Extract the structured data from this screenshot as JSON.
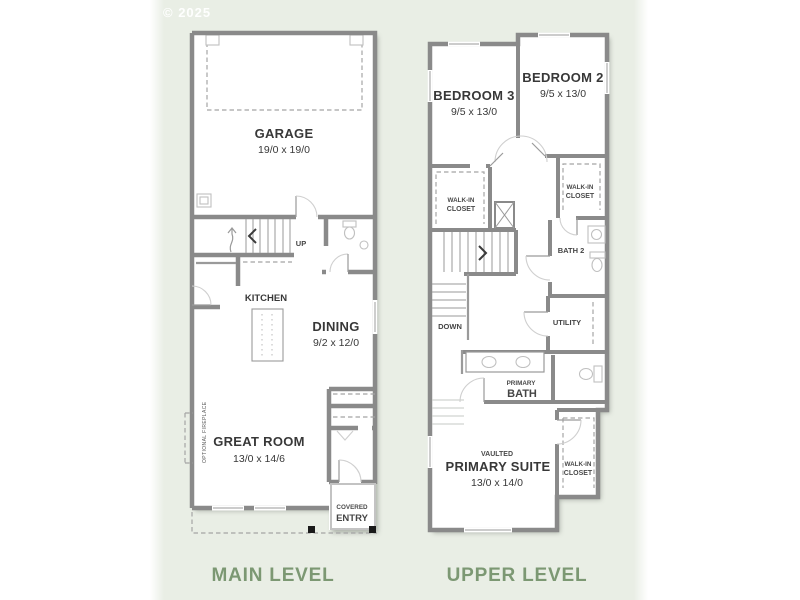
{
  "watermark": "© 2025",
  "colors": {
    "panel_background": "#e9eee5",
    "level_label": "#7c9873",
    "wall": "#8a8a8a",
    "room_label": "#383838"
  },
  "main_level": {
    "title": "MAIN LEVEL",
    "garage": {
      "name": "GARAGE",
      "dims": "19/0 x 19/0"
    },
    "kitchen": {
      "name": "KITCHEN"
    },
    "dining": {
      "name": "DINING",
      "dims": "9/2 x 12/0"
    },
    "great_room": {
      "name": "GREAT ROOM",
      "dims": "13/0 x 14/6"
    },
    "stairs": {
      "label": "UP"
    },
    "fireplace": {
      "label": "OPTIONAL FIREPLACE"
    },
    "covered_entry": {
      "line1": "COVERED",
      "line2": "ENTRY"
    }
  },
  "upper_level": {
    "title": "UPPER LEVEL",
    "bedroom3": {
      "name": "BEDROOM 3",
      "dims": "9/5 x 13/0"
    },
    "bedroom2": {
      "name": "BEDROOM 2",
      "dims": "9/5 x 13/0"
    },
    "closet_bedroom3": {
      "line1": "WALK-IN",
      "line2": "CLOSET"
    },
    "closet_bedroom2": {
      "line1": "WALK-IN",
      "line2": "CLOSET"
    },
    "closet_primary": {
      "line1": "WALK-IN",
      "line2": "CLOSET"
    },
    "bath2": {
      "name": "BATH 2"
    },
    "utility": {
      "name": "UTILITY"
    },
    "stairs": {
      "label": "DOWN"
    },
    "primary_bath": {
      "line1": "PRIMARY",
      "line2": "BATH"
    },
    "primary_suite": {
      "tag": "VAULTED",
      "name": "PRIMARY SUITE",
      "dims": "13/0 x 14/0"
    }
  }
}
